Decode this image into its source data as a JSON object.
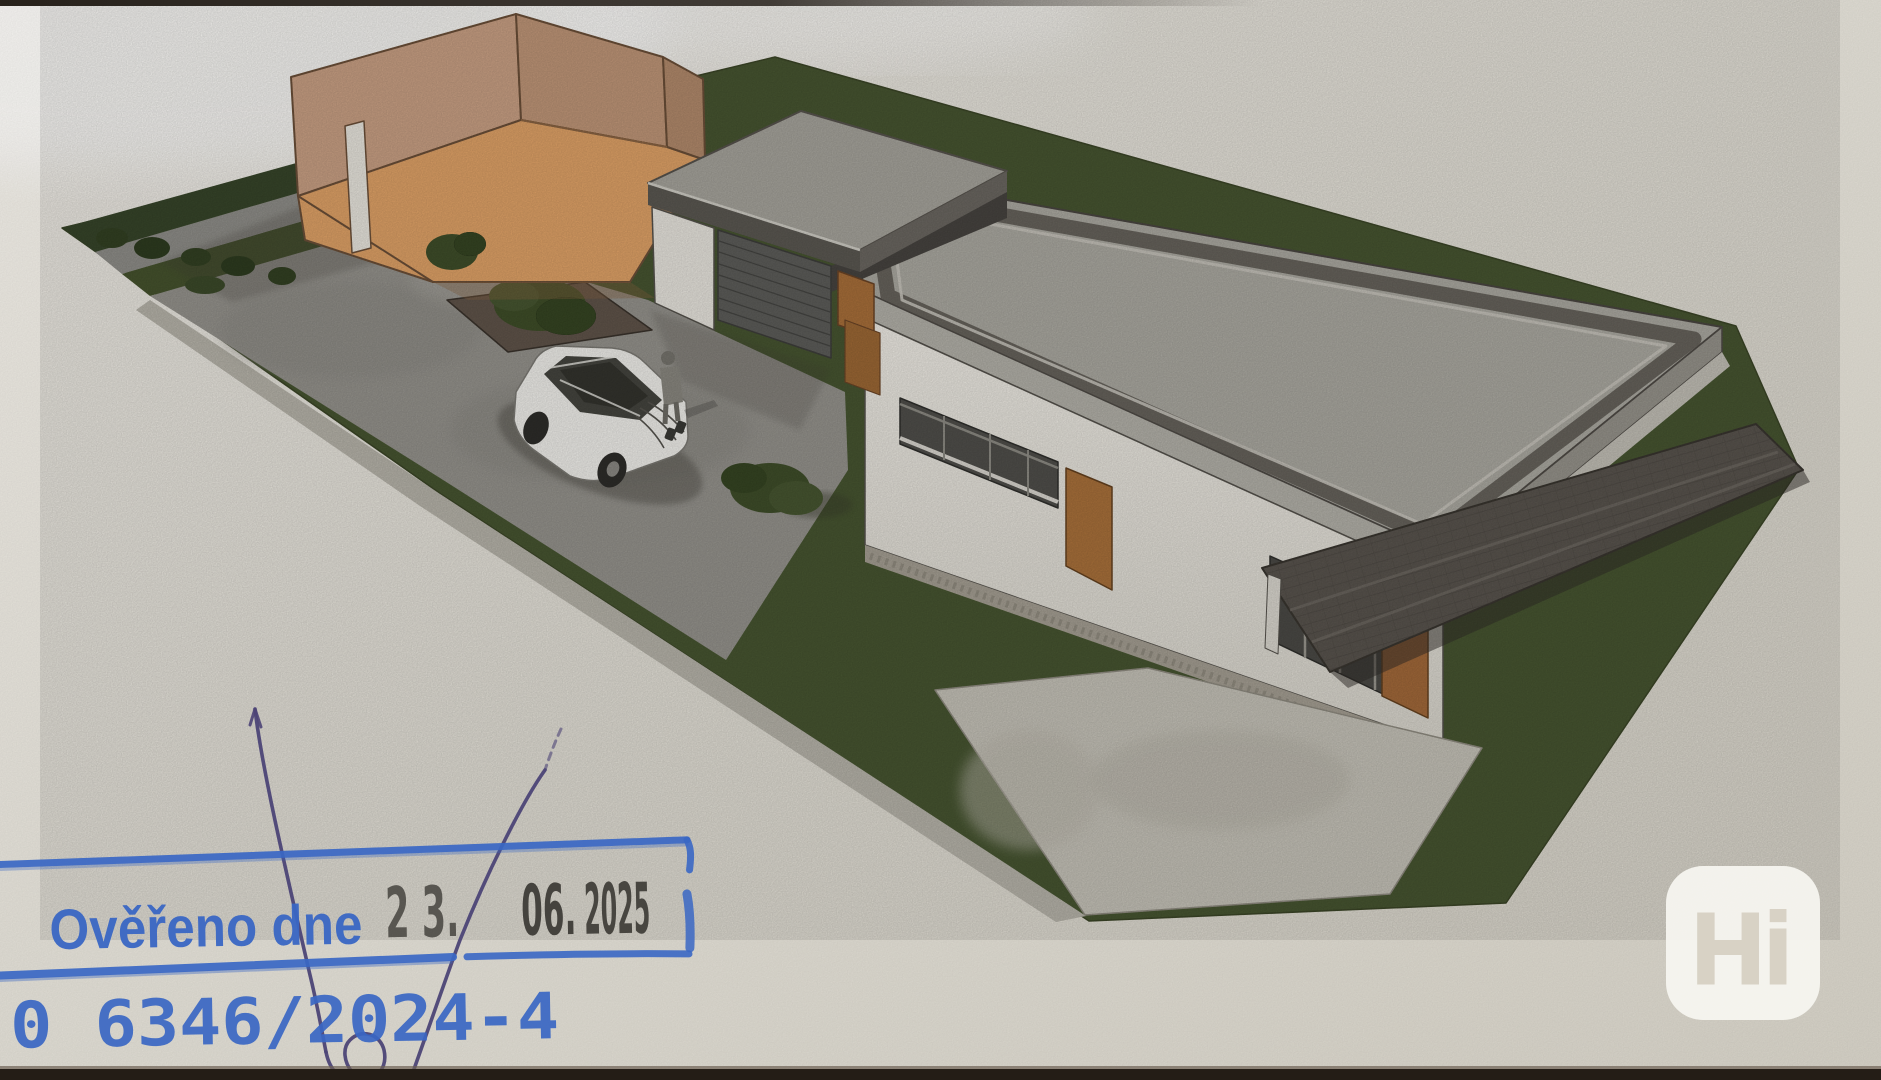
{
  "stamp": {
    "label": "Ověřeno dne",
    "date": {
      "day": "2 3.",
      "month": "06.",
      "year": "2025"
    },
    "registry_number": "0 6346/2024-4",
    "ink_color": "#3a67c4",
    "date_ink_color": "#3b3934"
  },
  "handwriting": {
    "pen_color": "#4c4476"
  },
  "watermark": {
    "text": "Hi",
    "badge_color": "#f7f5f0",
    "letter_color": "#d8d2c5"
  },
  "rendering_colors": {
    "paper": "#e4e0d7",
    "lawn_green": "#475531",
    "hedge_green": "#37452a",
    "paving_gray": "#95938d",
    "sidewalk_gray": "#b7b4aa",
    "roof_gray": "#aba9a1",
    "roof_border_dark": "#67635c",
    "wall_white": "#e9e6df",
    "neighbor_walls_tan": "#c9a084",
    "neighbor_walls_orange": "#dfa267",
    "garage_door_gray": "#5d5d5a",
    "wood_brown": "#a9713b",
    "terrace_roof_dark": "#59544e",
    "terrace_paving": "#c5c2b8",
    "car_body_white": "#f0efeb",
    "photo_edge_dark": "#241d16"
  }
}
